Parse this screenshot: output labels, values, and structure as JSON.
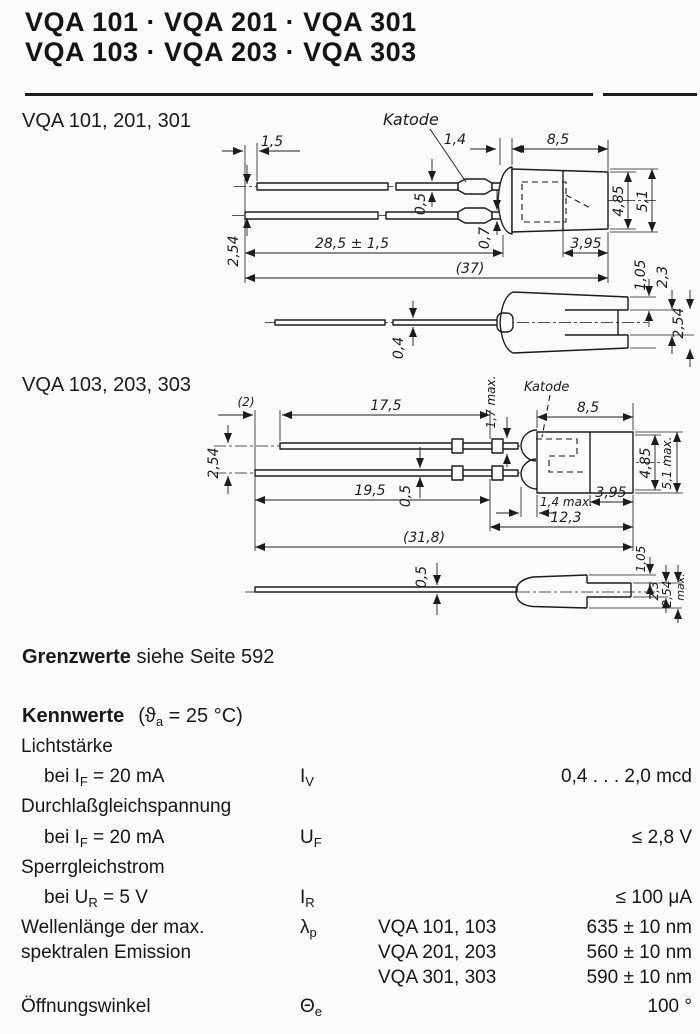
{
  "colors": {
    "ink": "#1a1a1a",
    "paper": "#fcfcfa"
  },
  "header": {
    "line1": "VQA 101 · VQA 201 · VQA 301",
    "line2": "VQA 103 · VQA 203 · VQA 303"
  },
  "drawing1": {
    "label": "VQA 101, 201, 301",
    "katode_label": "Katode",
    "dims": {
      "lead_offset": "1,5",
      "flange_w": "1,4",
      "body_len": "8,5",
      "lead_th_top": "0,5",
      "lead_th_bot": "0,7",
      "lead_pitch": "2,54",
      "lead_len": "28,5 ± 1,5",
      "overall_len": "(37)",
      "front_len": "3,95",
      "body_h1": "4,85",
      "body_h2": "5,1",
      "step_h": "1,05",
      "tab_h": "2,3",
      "side_lead_th": "0,4",
      "side_body_w": "2,54"
    }
  },
  "drawing2": {
    "label": "VQA 103, 203, 303",
    "katode_label": "Katode",
    "dims": {
      "lead_offset": "(2)",
      "lead_top_len": "17,5",
      "crimp_h": "1,7 max.",
      "body_len": "8,5",
      "lead_pitch": "2,54",
      "lead_th": "0,5",
      "lead_bot_len": "19,5",
      "flange_w": "1,4 max.",
      "front_len": "3,95",
      "body_total_len": "12,3",
      "overall_len": "(31,8)",
      "body_h1": "4,85",
      "body_h2": "5,1 max.",
      "side_lead_th": "0,5",
      "step_h": "1,05",
      "tab_h": "2,3",
      "side_body_w": "2,54",
      "side_body_w_suffix": "max."
    }
  },
  "limits_note": {
    "bold": "Grenzwerte",
    "rest": " siehe Seite 592"
  },
  "kennwerte": {
    "heading": "Kennwerte",
    "cond_pre": "(ϑ",
    "cond_sub": "a",
    "cond_post": " = 25 °C)"
  },
  "table": {
    "lichtstaerke": {
      "group": "Lichtstärke",
      "cond_pre": "bei I",
      "cond_sub": "F",
      "cond_post": " = 20 mA",
      "sym": "I",
      "sym_sub": "V",
      "value": "0,4 . . . 2,0 mcd"
    },
    "durchlass": {
      "group": "Durchlaßgleichspannung",
      "cond_pre": "bei I",
      "cond_sub": "F",
      "cond_post": " = 20 mA",
      "sym": "U",
      "sym_sub": "F",
      "value": "≤ 2,8 V"
    },
    "sperr": {
      "group": "Sperrgleichstrom",
      "cond_pre": "bei U",
      "cond_sub": "R",
      "cond_post": " = 5 V",
      "sym": "I",
      "sym_sub": "R",
      "value": "≤ 100 μA"
    },
    "wellenlaenge": {
      "label1": "Wellenlänge der max.",
      "label2": "spektralen Emission",
      "sym": "λ",
      "sym_sub": "p",
      "entries": [
        {
          "types": "VQA 101, 103",
          "value": "635 ± 10 nm"
        },
        {
          "types": "VQA 201, 203",
          "value": "560 ± 10 nm"
        },
        {
          "types": "VQA 301, 303",
          "value": "590 ± 10 nm"
        }
      ]
    },
    "oeffnung": {
      "label": "Öffnungswinkel",
      "sym": "Θ",
      "sym_sub": "e",
      "value": "100 °"
    }
  }
}
